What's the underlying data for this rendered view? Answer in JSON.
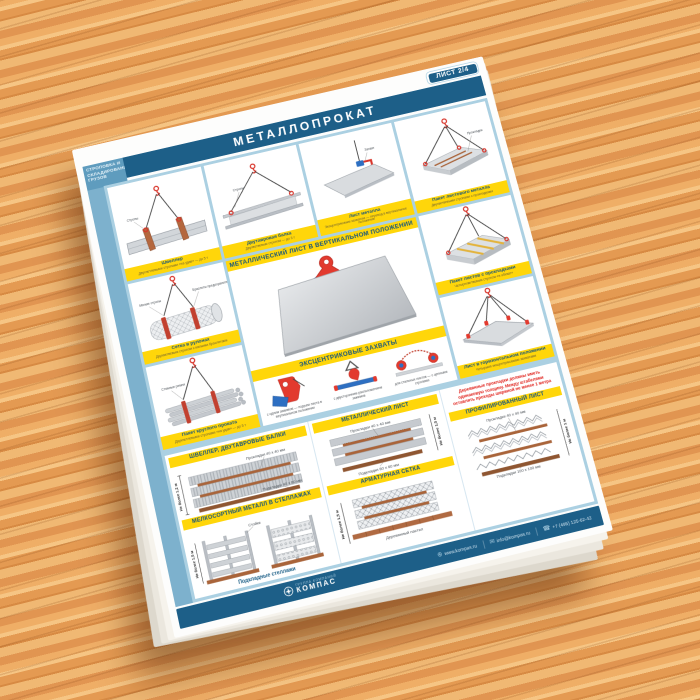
{
  "badge": "ЛИСТ 2/4",
  "title": "МЕТАЛЛОПРОКАТ",
  "sidebar": "СТРОПОВКА И\nСКЛАДИРОВАНИЕ\nГРУЗОВ",
  "panels": [
    {
      "title": "Швеллер",
      "subtitle": "Двухпетлевыми стропами «на удав» — до 5 т",
      "label": "Стропы"
    },
    {
      "title": "Двутавровая балка",
      "subtitle": "Двухветвевым стропом — до 3 т",
      "label": "Стропы"
    },
    {
      "title": "Лист металла",
      "subtitle": "Эксцентриковым захватом — перевод в вертикальное положение",
      "label": "Захват"
    },
    {
      "title": "Пакет листового металла",
      "subtitle": "Двухветвевыми стропами с прокладками",
      "label": "Прокладки"
    },
    {
      "title": "Сетка в рулонах",
      "subtitle": "Двухветвевым стропом с мягкими браслетами",
      "labels": [
        "Мягкие стропы",
        "Браслеты предохранительные"
      ]
    },
    {
      "title": "Пакет листов с прокладками",
      "subtitle": "Четырехветвевым стропом «в обхват»"
    },
    {
      "title": "Пакет круглого проката",
      "subtitle": "Двухпетлевыми стропами «на удав» — до 5 т",
      "label": "Стяжные ремни"
    },
    {
      "title": "Лист в горизонтальном положении",
      "subtitle": "Четырьмя эксцентриковыми захватами"
    }
  ],
  "center": {
    "heading_top": "МЕТАЛЛИЧЕСКИЙ ЛИСТ В ВЕРТИКАЛЬНОМ ПОЛОЖЕНИИ",
    "heading_bottom": "ЭКСЦЕНТРИКОВЫЕ ЗАХВАТЫ",
    "clamps": [
      {
        "caption": "с одним зажимом — подъем листа в вертикальном положении"
      },
      {
        "caption": "с двусторонним расположением зажимов"
      },
      {
        "caption": "для стальных листов — с цепными стропами"
      }
    ]
  },
  "storage": {
    "shveller": {
      "heading": "ШВЕЛЛЕР, ДВУТАВРОВЫЕ БАЛКИ",
      "labels": [
        "Прокладки 40 х 40 мм",
        "Подкладки 40 х 80 мм"
      ],
      "height_note": "Не более 1,2 м"
    },
    "melkosort": {
      "heading": "МЕЛКОСОРТНЫЙ МЕТАЛЛ В СТЕЛЛАЖАХ",
      "labels": [
        "Стойки",
        "Подкладные стеллажи"
      ],
      "height_note": "Не более 1,5 м"
    },
    "metallist": {
      "heading": "МЕТАЛЛИЧЕСКИЙ ЛИСТ",
      "labels": [
        "Прокладки 40 х 40 мм",
        "Подкладки 60 х 60 мм"
      ],
      "height_note": "Не более 1,5 м"
    },
    "armatura": {
      "heading": "АРМАТУРНАЯ СЕТКА",
      "labels": [
        "Деревянный настил"
      ],
      "height_note": "Не более 1,5 м"
    },
    "proflist": {
      "heading": "ПРОФИЛИРОВАННЫЙ ЛИСТ",
      "labels": [
        "Прокладки 40 х 40 мм",
        "Подкладки 100 х 100 мм"
      ],
      "height_note": "Не более 1 м"
    },
    "warning": "Деревянные прокладки должны иметь одинаковую толщину. Между штабелями оставлять проходы шириной не менее 1 метра"
  },
  "footer": {
    "brand": "КОМПАС",
    "brand_tagline": "ГРУППА КОМПАНИЙ",
    "website": "www.kompas.ru",
    "email": "info@kompas.ru",
    "phone": "+7 (495) 125-62-42"
  },
  "colors": {
    "accent_blue": "#1d5f88",
    "frame_blue": "#abd0e2",
    "yellow": "#ffd60a",
    "red": "#e23a2e"
  }
}
